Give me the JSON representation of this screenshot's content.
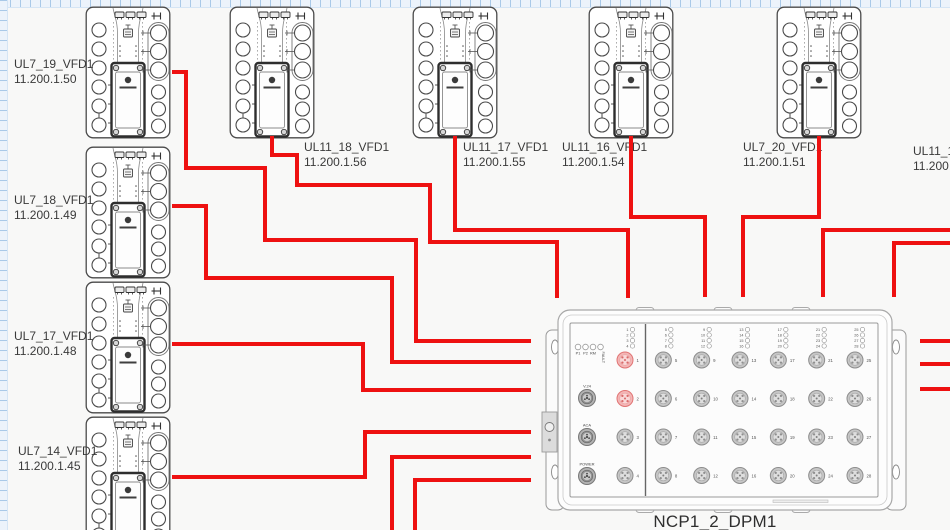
{
  "canvas": {
    "width": 950,
    "height": 530
  },
  "colors": {
    "cable": "#ee1111",
    "device_stroke": "#4a4a4a",
    "label_text": "#3a3a3a",
    "canvas_bg": "#f8f8f7",
    "port_gray": "#c6c6c6",
    "port_red": "#f3b6b6"
  },
  "devices": [
    {
      "name": "UL7_19_VFD1",
      "ip": "11.200.1.50",
      "x": 85,
      "y": 6,
      "label_x": 14,
      "label_y": 57
    },
    {
      "name": "UL7_18_VFD1",
      "ip": "11.200.1.49",
      "x": 85,
      "y": 146,
      "label_x": 14,
      "label_y": 193
    },
    {
      "name": "UL7_17_VFD1",
      "ip": "11.200.1.48",
      "x": 85,
      "y": 281,
      "label_x": 14,
      "label_y": 329
    },
    {
      "name": "UL7_14_VFD1",
      "ip": "11.200.1.45",
      "x": 85,
      "y": 416,
      "label_x": 18,
      "label_y": 444
    },
    {
      "name": "UL11_18_VFD1",
      "ip": "11.200.1.56",
      "x": 229,
      "y": 6,
      "label_x": 304,
      "label_y": 140
    },
    {
      "name": "UL11_17_VFD1",
      "ip": "11.200.1.55",
      "x": 412,
      "y": 6,
      "label_x": 463,
      "label_y": 140
    },
    {
      "name": "UL11_16_VFD1",
      "ip": "11.200.1.54",
      "x": 588,
      "y": 6,
      "label_x": 562,
      "label_y": 140
    },
    {
      "name": "UL7_20_VFD1",
      "ip": "11.200.1.51",
      "x": 776,
      "y": 6,
      "label_x": 743,
      "label_y": 140
    }
  ],
  "offscreen_label": {
    "name": "UL11_14",
    "ip": "11.200.1",
    "label_x": 913,
    "label_y": 144
  },
  "switch": {
    "label": "NCP1_2_DPM1",
    "x": 540,
    "y": 300,
    "status_leds": [
      "P1",
      "P2",
      "RM",
      "FAULT"
    ],
    "connector_labels": [
      "V.24",
      "ACA",
      "POWER"
    ],
    "port_count": 28,
    "highlighted_ports": [
      1,
      2
    ]
  },
  "cables": [
    {
      "id": "ul7-19",
      "from": "UL7_19_VFD1",
      "to": "NCP1_2_DPM1",
      "points": [
        [
          172,
          72
        ],
        [
          186,
          72
        ],
        [
          186,
          168
        ],
        [
          265,
          168
        ],
        [
          265,
          240
        ],
        [
          416,
          240
        ],
        [
          416,
          341
        ],
        [
          531,
          341
        ]
      ]
    },
    {
      "id": "ul7-18",
      "from": "UL7_18_VFD1",
      "to": "NCP1_2_DPM1",
      "points": [
        [
          172,
          206
        ],
        [
          206,
          206
        ],
        [
          206,
          278
        ],
        [
          392,
          278
        ],
        [
          392,
          362
        ],
        [
          531,
          362
        ]
      ]
    },
    {
      "id": "ul7-17",
      "from": "UL7_17_VFD1",
      "to": "NCP1_2_DPM1",
      "points": [
        [
          172,
          344
        ],
        [
          363,
          344
        ],
        [
          363,
          390
        ],
        [
          531,
          390
        ]
      ]
    },
    {
      "id": "ul7-14",
      "from": "UL7_14_VFD1",
      "to": "NCP1_2_DPM1",
      "points": [
        [
          172,
          477
        ],
        [
          365,
          477
        ],
        [
          365,
          432
        ],
        [
          531,
          432
        ]
      ]
    },
    {
      "id": "ul11-18",
      "from": "UL11_18_VFD1",
      "to": "NCP1_2_DPM1",
      "points": [
        [
          272,
          136
        ],
        [
          272,
          155
        ],
        [
          297,
          155
        ],
        [
          297,
          185
        ],
        [
          430,
          185
        ],
        [
          430,
          242
        ],
        [
          557,
          242
        ],
        [
          557,
          298
        ]
      ]
    },
    {
      "id": "ul11-17",
      "from": "UL11_17_VFD1",
      "to": "NCP1_2_DPM1",
      "points": [
        [
          455,
          136
        ],
        [
          455,
          230
        ],
        [
          628,
          230
        ],
        [
          628,
          298
        ]
      ]
    },
    {
      "id": "ul11-16",
      "from": "UL11_16_VFD1",
      "to": "NCP1_2_DPM1",
      "points": [
        [
          631,
          136
        ],
        [
          631,
          217
        ],
        [
          705,
          217
        ],
        [
          705,
          297
        ]
      ]
    },
    {
      "id": "ul7-20",
      "from": "UL7_20_VFD1",
      "to": "NCP1_2_DPM1",
      "points": [
        [
          819,
          136
        ],
        [
          819,
          217
        ],
        [
          743,
          217
        ],
        [
          743,
          297
        ]
      ]
    },
    {
      "id": "right-in-upper",
      "from": "offscreen-right",
      "to": "NCP1_2_DPM1",
      "points": [
        [
          950,
          230
        ],
        [
          823,
          230
        ],
        [
          823,
          297
        ]
      ]
    },
    {
      "id": "right-in-lower",
      "from": "offscreen-right",
      "to": "NCP1_2_DPM1",
      "points": [
        [
          950,
          243
        ],
        [
          894,
          243
        ],
        [
          894,
          297
        ]
      ]
    },
    {
      "id": "bottom-out-1",
      "from": "NCP1_2_DPM1",
      "to": "offscreen-bottom",
      "points": [
        [
          531,
          457
        ],
        [
          392,
          457
        ],
        [
          392,
          531
        ]
      ]
    },
    {
      "id": "bottom-out-2",
      "from": "NCP1_2_DPM1",
      "to": "offscreen-bottom",
      "points": [
        [
          531,
          480
        ],
        [
          415,
          480
        ],
        [
          415,
          531
        ]
      ]
    },
    {
      "id": "right-out-1",
      "from": "NCP1_2_DPM1",
      "to": "offscreen-right",
      "points": [
        [
          920,
          341
        ],
        [
          950,
          341
        ]
      ]
    },
    {
      "id": "right-out-2",
      "from": "NCP1_2_DPM1",
      "to": "offscreen-right",
      "points": [
        [
          920,
          364
        ],
        [
          950,
          364
        ]
      ]
    },
    {
      "id": "right-out-3",
      "from": "NCP1_2_DPM1",
      "to": "offscreen-right",
      "points": [
        [
          920,
          389
        ],
        [
          950,
          389
        ]
      ]
    }
  ]
}
